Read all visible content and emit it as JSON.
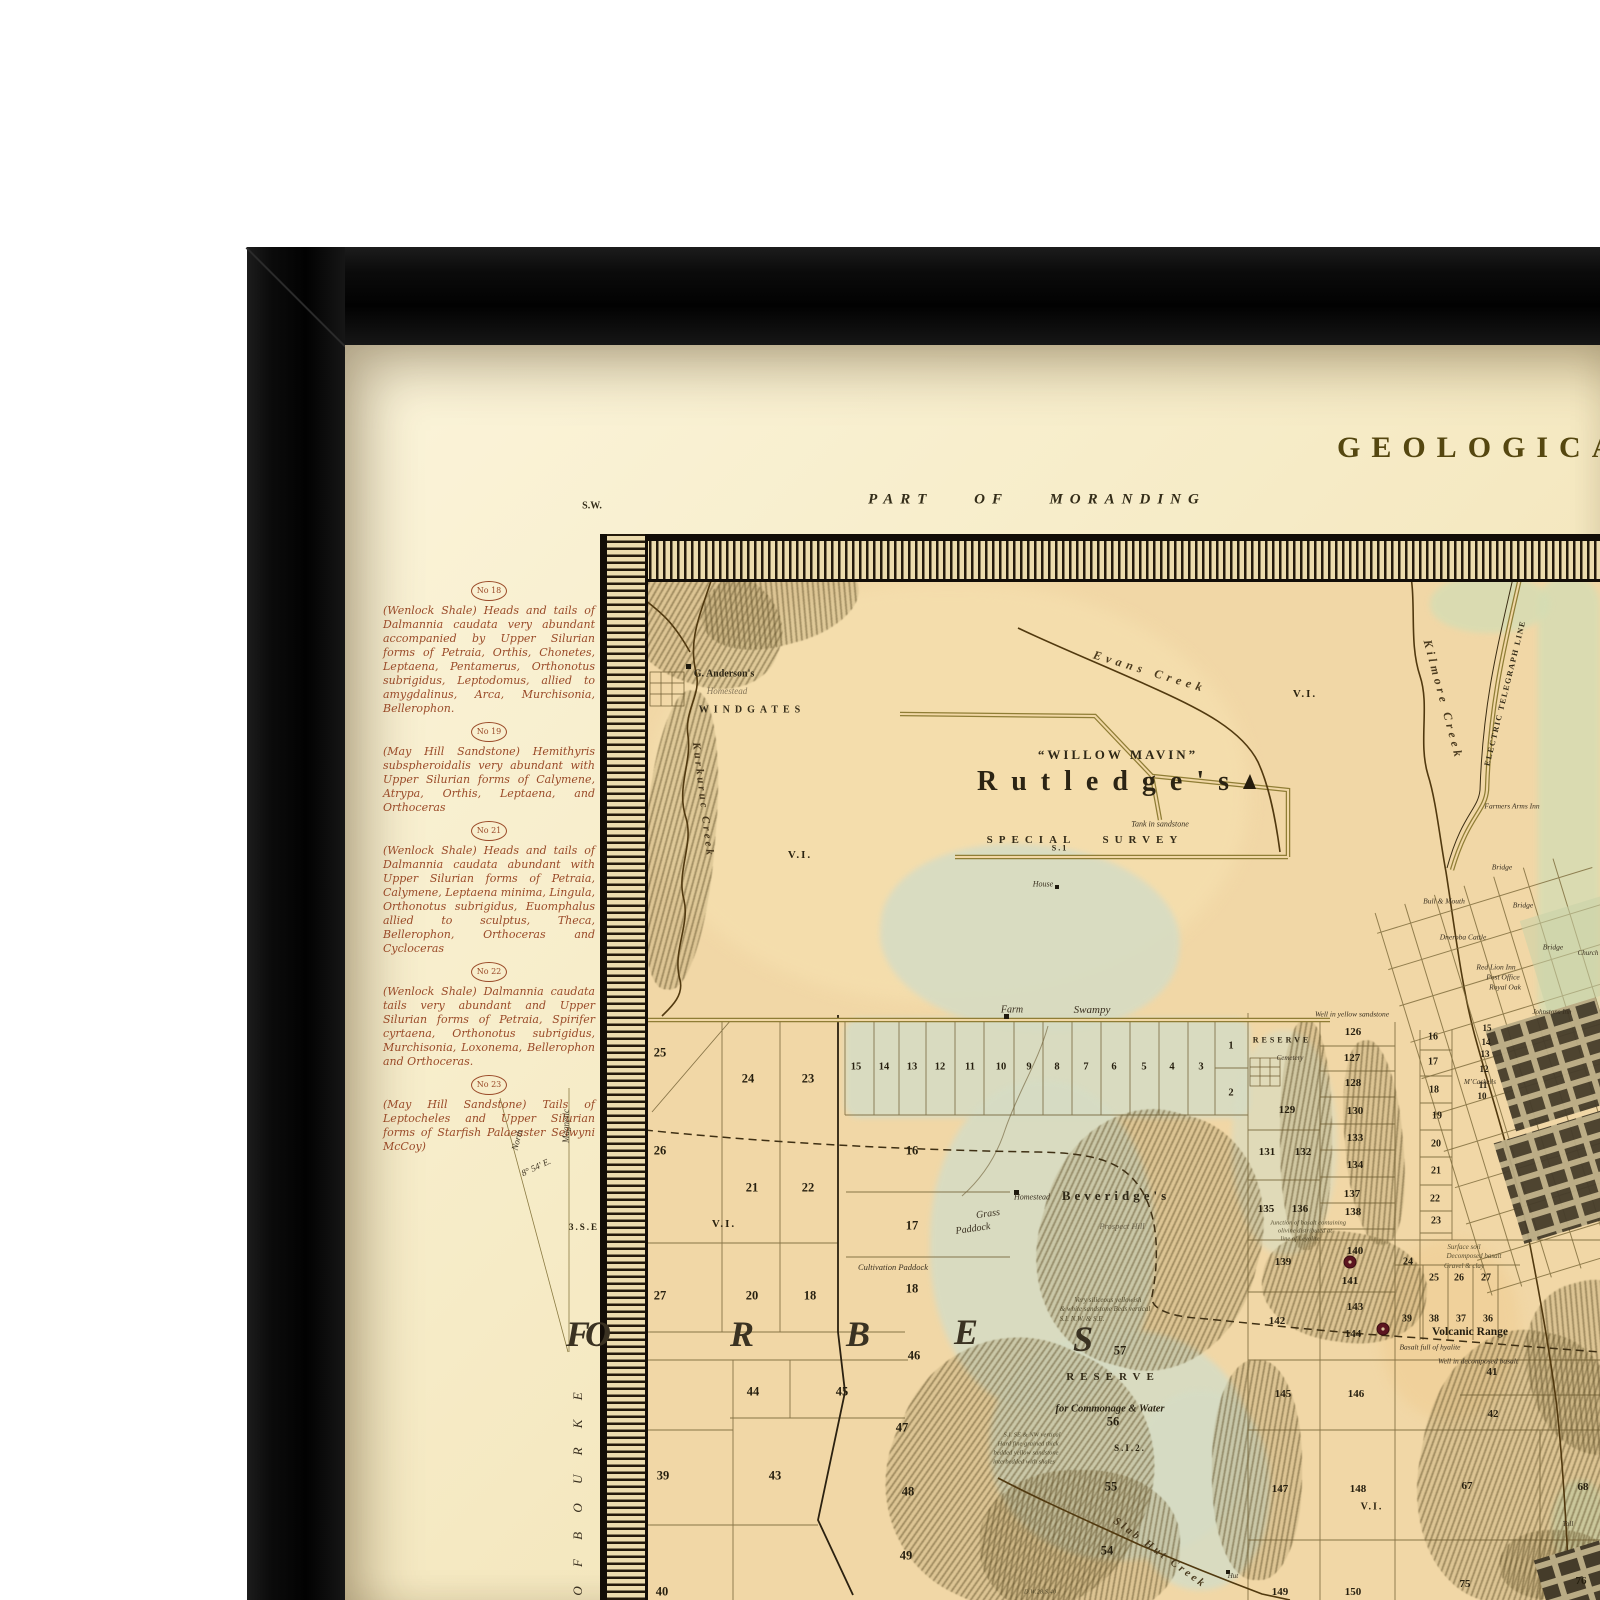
{
  "colors": {
    "frame": "#0b0b0b",
    "paper": "#f6ecca",
    "map_ground": "#f1d7a6",
    "swamp": "#d6dcc4",
    "hills": "#7d6f45",
    "ink": "#3a3020",
    "margin_ink": "#9a4a28",
    "crater": "#5c1520"
  },
  "paper": {
    "title": "GEOLOGICAL",
    "district_label": "PART OF MORANDING",
    "corner_label": "S.W."
  },
  "margin": {
    "notes": [
      {
        "no": "No 18",
        "text": "(Wenlock Shale) Heads and tails of Dalmannia caudata very abundant accompanied by Upper Silurian forms of Petraia, Orthis, Chonetes, Leptaena, Pentamerus, Orthonotus subrigidus, Leptodomus, allied to amygdalinus, Arca, Murchisonia, Bellerophon."
      },
      {
        "no": "No 19",
        "text": "(May Hill Sandstone) Hemithyris subspheroidalis very abundant with Upper Silurian forms of Calymene, Atrypa, Orthis, Leptaena, and Orthoceras"
      },
      {
        "no": "No 21",
        "text": "(Wenlock Shale) Heads and tails of Dalmannia caudata abundant with Upper Silurian forms of Petraia, Calymene, Leptaena minima, Lingula, Orthonotus subrigidus, Euomphalus allied to sculptus, Theca, Bellerophon, Orthoceras and Cycloceras"
      },
      {
        "no": "No 22",
        "text": "(Wenlock Shale) Dalmannia caudata tails very abundant and Upper Silurian forms of Petraia, Spirifer cyrtaena, Orthonotus subrigidus, Murchisonia, Loxonema, Bellerophon and Orthoceras."
      },
      {
        "no": "No 23",
        "text": "(May Hill Sandstone) Tails of Leptocheles and Upper Silurian forms of Starfish Palaeaster Selwyni McCoy)"
      }
    ]
  },
  "declination": {
    "north_label": "North",
    "magnetic_label": "Magnetic",
    "angle": "8° 54' E.",
    "se_mark": "3.S.E"
  },
  "map": {
    "labels": [
      {
        "t": "G. Anderson's",
        "x": 724,
        "y": 674,
        "s": 10,
        "c": "name"
      },
      {
        "t": "Homestead",
        "x": 727,
        "y": 691,
        "s": 9,
        "c": "it faint"
      },
      {
        "t": "WINDGATES",
        "x": 752,
        "y": 710,
        "s": 10,
        "ls": 5,
        "c": "sc"
      },
      {
        "t": "Kurkuruc Creek",
        "x": 703,
        "y": 800,
        "r": 83,
        "s": 11,
        "ls": 3,
        "c": "creek"
      },
      {
        "t": "Evans Creek",
        "x": 1150,
        "y": 672,
        "r": 17,
        "s": 12,
        "ls": 5,
        "c": "creek"
      },
      {
        "t": "V.I.",
        "x": 1305,
        "y": 694,
        "s": 11,
        "c": "num2"
      },
      {
        "t": "Kilmore Creek",
        "x": 1443,
        "y": 700,
        "r": 75,
        "s": 12,
        "ls": 4,
        "c": "creek"
      },
      {
        "t": "ELECTRIC TELEGRAPH LINE",
        "x": 1505,
        "y": 693,
        "r": -76,
        "s": 8,
        "ls": 1.5,
        "c": "sc"
      },
      {
        "t": "Farmers Arms Inn",
        "x": 1512,
        "y": 806,
        "s": 7.5,
        "c": "it"
      },
      {
        "t": "“WILLOW MAVIN”",
        "x": 1118,
        "y": 755,
        "s": 13,
        "ls": 3,
        "c": "bsc"
      },
      {
        "t": "Rutledge's",
        "x": 1110,
        "y": 782,
        "s": 28,
        "ls": 14,
        "c": "name2"
      },
      {
        "t": "Tank in sandstone",
        "x": 1160,
        "y": 824,
        "s": 8,
        "c": "it"
      },
      {
        "t": "S.1",
        "x": 1060,
        "y": 848,
        "s": 8,
        "c": "num2"
      },
      {
        "t": "SPECIAL SURVEY",
        "x": 1085,
        "y": 840,
        "s": 11,
        "ls": 6,
        "ws": 18,
        "c": "sc"
      },
      {
        "t": "House",
        "x": 1043,
        "y": 884,
        "s": 8,
        "c": "it"
      },
      {
        "t": "V.I.",
        "x": 800,
        "y": 855,
        "s": 11,
        "c": "num2"
      },
      {
        "t": "Farm",
        "x": 1012,
        "y": 1010,
        "s": 10,
        "c": "it"
      },
      {
        "t": "Swampy",
        "x": 1092,
        "y": 1010,
        "s": 11,
        "c": "it"
      },
      {
        "t": "Well in yellow sandstone",
        "x": 1352,
        "y": 1014,
        "s": 7.5,
        "c": "it"
      },
      {
        "t": "RESERVE",
        "x": 1282,
        "y": 1040,
        "s": 8,
        "ls": 3,
        "c": "sc"
      },
      {
        "t": "Cemetery",
        "x": 1290,
        "y": 1058,
        "s": 7,
        "c": "it"
      },
      {
        "t": "M’Caskells",
        "x": 1480,
        "y": 1082,
        "s": 7,
        "c": "it"
      },
      {
        "t": "Bridge",
        "x": 1502,
        "y": 867,
        "s": 7.5,
        "c": "it"
      },
      {
        "t": "Bull & Mouth",
        "x": 1444,
        "y": 901,
        "s": 7.5,
        "c": "it"
      },
      {
        "t": "Bridge",
        "x": 1523,
        "y": 905,
        "s": 7.5,
        "c": "it"
      },
      {
        "t": "Dneroba Cattle",
        "x": 1463,
        "y": 937,
        "s": 7.5,
        "c": "it"
      },
      {
        "t": "Bridge",
        "x": 1553,
        "y": 947,
        "s": 7.5,
        "c": "it"
      },
      {
        "t": "Church",
        "x": 1588,
        "y": 953,
        "s": 7,
        "c": "it"
      },
      {
        "t": "Red Lion Inn",
        "x": 1496,
        "y": 967,
        "s": 7.5,
        "c": "it"
      },
      {
        "t": "Post Office",
        "x": 1503,
        "y": 977,
        "s": 7.5,
        "c": "it"
      },
      {
        "t": "Royal Oak",
        "x": 1505,
        "y": 987,
        "s": 7.5,
        "c": "it"
      },
      {
        "t": "Johnstons Inn",
        "x": 1552,
        "y": 1012,
        "s": 7,
        "c": "it"
      },
      {
        "t": "Grass",
        "x": 988,
        "y": 1214,
        "r": -8,
        "s": 10,
        "c": "it"
      },
      {
        "t": "Paddock",
        "x": 973,
        "y": 1229,
        "r": -8,
        "s": 10,
        "c": "it"
      },
      {
        "t": "Homestead",
        "x": 1032,
        "y": 1197,
        "s": 8,
        "c": "it"
      },
      {
        "t": "Beveridge's",
        "x": 1116,
        "y": 1196,
        "s": 13,
        "ls": 4,
        "c": "name"
      },
      {
        "t": "Prospect Hill",
        "x": 1122,
        "y": 1226,
        "s": 8.5,
        "c": "it faint"
      },
      {
        "t": "Cultivation Paddock",
        "x": 893,
        "y": 1267,
        "s": 8.5,
        "c": "it"
      },
      {
        "t": "V.I.",
        "x": 724,
        "y": 1224,
        "s": 11,
        "c": "num2"
      },
      {
        "t": "F",
        "x": 578,
        "y": 1334,
        "s": 36,
        "c": "big"
      },
      {
        "t": "O",
        "x": 598,
        "y": 1334,
        "s": 36,
        "c": "big"
      },
      {
        "t": "R",
        "x": 742,
        "y": 1334,
        "s": 36,
        "c": "big"
      },
      {
        "t": "B",
        "x": 858,
        "y": 1334,
        "s": 36,
        "c": "big"
      },
      {
        "t": "E",
        "x": 966,
        "y": 1332,
        "s": 36,
        "c": "big"
      },
      {
        "t": "S",
        "x": 1083,
        "y": 1339,
        "s": 36,
        "c": "big"
      },
      {
        "t": "Very siliceous yellowish",
        "x": 1108,
        "y": 1300,
        "s": 7,
        "c": "note"
      },
      {
        "t": "& white sandstone Beds vertical",
        "x": 1105,
        "y": 1309,
        "s": 7,
        "c": "note"
      },
      {
        "t": "S.I. N.W. & S.E.",
        "x": 1082,
        "y": 1319,
        "s": 7,
        "c": "note"
      },
      {
        "t": "RESERVE",
        "x": 1113,
        "y": 1377,
        "s": 11,
        "ls": 6,
        "c": "sc"
      },
      {
        "t": "for Commonage & Water",
        "x": 1110,
        "y": 1409,
        "s": 10.5,
        "c": "bit"
      },
      {
        "t": "S.I.2.",
        "x": 1130,
        "y": 1448,
        "s": 9,
        "c": "num2"
      },
      {
        "t": "S.I. SE & NW vertical",
        "x": 1032,
        "y": 1435,
        "s": 6.5,
        "c": "note"
      },
      {
        "t": "Hard fine grained thick",
        "x": 1028,
        "y": 1444,
        "s": 6.5,
        "c": "note"
      },
      {
        "t": "bedded yellow sandstone",
        "x": 1026,
        "y": 1453,
        "s": 6.5,
        "c": "note"
      },
      {
        "t": "interbedded with shales",
        "x": 1024,
        "y": 1462,
        "s": 6.5,
        "c": "note"
      },
      {
        "t": "Slab Hut Creek",
        "x": 1160,
        "y": 1553,
        "r": 36,
        "s": 11,
        "ls": 3,
        "c": "creek"
      },
      {
        "t": "Hut",
        "x": 1233,
        "y": 1576,
        "s": 7,
        "c": "it"
      },
      {
        "t": "Surface soil",
        "x": 1464,
        "y": 1247,
        "s": 7,
        "c": "note"
      },
      {
        "t": "Decomposed basalt",
        "x": 1474,
        "y": 1256,
        "s": 7,
        "c": "note"
      },
      {
        "t": "Gravel & clay",
        "x": 1464,
        "y": 1266,
        "s": 7,
        "c": "note"
      },
      {
        "t": "Volcanic Range",
        "x": 1470,
        "y": 1332,
        "s": 11.5,
        "c": "bname"
      },
      {
        "t": "Basalt full of hyalite",
        "x": 1430,
        "y": 1347,
        "s": 7.5,
        "c": "it"
      },
      {
        "t": "Well in decomposed basalt",
        "x": 1478,
        "y": 1361,
        "s": 7.5,
        "c": "it"
      },
      {
        "t": "Junction of basalt containing",
        "x": 1308,
        "y": 1223,
        "s": 6.5,
        "c": "note"
      },
      {
        "t": "olivine distributed at",
        "x": 1305,
        "y": 1231,
        "s": 6.5,
        "c": "note"
      },
      {
        "t": "line of Leyolite",
        "x": 1300,
        "y": 1239,
        "s": 6.5,
        "c": "note"
      },
      {
        "t": "V.I.",
        "x": 1372,
        "y": 1507,
        "s": 10,
        "c": "num2"
      },
      {
        "t": "Toll",
        "x": 1568,
        "y": 1524,
        "s": 7,
        "c": "it"
      },
      {
        "t": "D.W.28.S.40",
        "x": 1040,
        "y": 1592,
        "s": 6.5,
        "c": "note"
      },
      {
        "t": "3.S.E",
        "x": 584,
        "y": 1227,
        "s": 9,
        "c": "num2"
      },
      {
        "t": "North",
        "x": 517,
        "y": 1140,
        "r": -75,
        "s": 9,
        "c": "it"
      },
      {
        "t": "Magnetic",
        "x": 566,
        "y": 1126,
        "r": -90,
        "s": 9,
        "c": "it"
      },
      {
        "t": "8° 54' E.",
        "x": 536,
        "y": 1167,
        "r": -25,
        "s": 9,
        "c": "it"
      },
      {
        "t": "O F   B O U R K E",
        "x": 578,
        "y": 1490,
        "r": -90,
        "s": 13,
        "ls": 8,
        "c": "it"
      }
    ],
    "parcels": [
      {
        "n": "25",
        "x": 660,
        "y": 1053
      },
      {
        "n": "24",
        "x": 748,
        "y": 1079
      },
      {
        "n": "23",
        "x": 808,
        "y": 1079
      },
      {
        "n": "15",
        "x": 856,
        "y": 1067,
        "s": 10.5
      },
      {
        "n": "14",
        "x": 884,
        "y": 1067,
        "s": 10.5
      },
      {
        "n": "13",
        "x": 912,
        "y": 1067,
        "s": 10.5
      },
      {
        "n": "12",
        "x": 940,
        "y": 1067,
        "s": 10.5
      },
      {
        "n": "11",
        "x": 970,
        "y": 1067,
        "s": 10.5
      },
      {
        "n": "10",
        "x": 1001,
        "y": 1067,
        "s": 10.5
      },
      {
        "n": "9",
        "x": 1029,
        "y": 1067,
        "s": 10.5
      },
      {
        "n": "8",
        "x": 1057,
        "y": 1067,
        "s": 10.5
      },
      {
        "n": "7",
        "x": 1086,
        "y": 1067,
        "s": 10.5
      },
      {
        "n": "6",
        "x": 1114,
        "y": 1067,
        "s": 10.5
      },
      {
        "n": "5",
        "x": 1144,
        "y": 1067,
        "s": 10.5
      },
      {
        "n": "4",
        "x": 1172,
        "y": 1067,
        "s": 10.5
      },
      {
        "n": "3",
        "x": 1201,
        "y": 1067,
        "s": 10.5
      },
      {
        "n": "1",
        "x": 1231,
        "y": 1046,
        "s": 10.5
      },
      {
        "n": "2",
        "x": 1231,
        "y": 1093,
        "s": 10.5
      },
      {
        "n": "26",
        "x": 660,
        "y": 1151
      },
      {
        "n": "16",
        "x": 912,
        "y": 1151
      },
      {
        "n": "21",
        "x": 752,
        "y": 1188
      },
      {
        "n": "22",
        "x": 808,
        "y": 1188
      },
      {
        "n": "17",
        "x": 912,
        "y": 1226
      },
      {
        "n": "27",
        "x": 660,
        "y": 1296
      },
      {
        "n": "20",
        "x": 752,
        "y": 1296
      },
      {
        "n": "18",
        "x": 810,
        "y": 1296
      },
      {
        "n": "18",
        "x": 912,
        "y": 1289
      },
      {
        "n": "46",
        "x": 914,
        "y": 1356
      },
      {
        "n": "57",
        "x": 1120,
        "y": 1351
      },
      {
        "n": "56",
        "x": 1113,
        "y": 1422
      },
      {
        "n": "55",
        "x": 1111,
        "y": 1487
      },
      {
        "n": "54",
        "x": 1107,
        "y": 1551
      },
      {
        "n": "44",
        "x": 753,
        "y": 1392
      },
      {
        "n": "45",
        "x": 842,
        "y": 1392
      },
      {
        "n": "39",
        "x": 663,
        "y": 1476
      },
      {
        "n": "43",
        "x": 775,
        "y": 1476
      },
      {
        "n": "47",
        "x": 902,
        "y": 1428
      },
      {
        "n": "48",
        "x": 908,
        "y": 1492
      },
      {
        "n": "49",
        "x": 906,
        "y": 1556
      },
      {
        "n": "40",
        "x": 662,
        "y": 1592
      },
      {
        "n": "126",
        "x": 1353,
        "y": 1032,
        "s": 11
      },
      {
        "n": "127",
        "x": 1352,
        "y": 1058,
        "s": 11
      },
      {
        "n": "128",
        "x": 1353,
        "y": 1083,
        "s": 11
      },
      {
        "n": "129",
        "x": 1287,
        "y": 1110,
        "s": 11
      },
      {
        "n": "130",
        "x": 1355,
        "y": 1111,
        "s": 11
      },
      {
        "n": "133",
        "x": 1355,
        "y": 1138,
        "s": 11
      },
      {
        "n": "131",
        "x": 1267,
        "y": 1152,
        "s": 11
      },
      {
        "n": "132",
        "x": 1303,
        "y": 1152,
        "s": 11
      },
      {
        "n": "134",
        "x": 1355,
        "y": 1165,
        "s": 11
      },
      {
        "n": "137",
        "x": 1352,
        "y": 1194,
        "s": 11
      },
      {
        "n": "135",
        "x": 1266,
        "y": 1209,
        "s": 11
      },
      {
        "n": "136",
        "x": 1300,
        "y": 1209,
        "s": 11
      },
      {
        "n": "138",
        "x": 1353,
        "y": 1212,
        "s": 11
      },
      {
        "n": "16",
        "x": 1433,
        "y": 1037,
        "s": 10
      },
      {
        "n": "17",
        "x": 1433,
        "y": 1062,
        "s": 10
      },
      {
        "n": "18",
        "x": 1434,
        "y": 1090,
        "s": 10
      },
      {
        "n": "19",
        "x": 1437,
        "y": 1116,
        "s": 10
      },
      {
        "n": "20",
        "x": 1436,
        "y": 1144,
        "s": 10
      },
      {
        "n": "21",
        "x": 1436,
        "y": 1171,
        "s": 10
      },
      {
        "n": "22",
        "x": 1435,
        "y": 1199,
        "s": 10
      },
      {
        "n": "23",
        "x": 1436,
        "y": 1221,
        "s": 10
      },
      {
        "n": "15",
        "x": 1487,
        "y": 1028,
        "s": 9
      },
      {
        "n": "14",
        "x": 1486,
        "y": 1042,
        "s": 9
      },
      {
        "n": "13",
        "x": 1485,
        "y": 1054,
        "s": 9
      },
      {
        "n": "12",
        "x": 1484,
        "y": 1069,
        "s": 9
      },
      {
        "n": "11",
        "x": 1483,
        "y": 1085,
        "s": 9
      },
      {
        "n": "10",
        "x": 1482,
        "y": 1096,
        "s": 9
      },
      {
        "n": "139",
        "x": 1283,
        "y": 1262,
        "s": 11
      },
      {
        "n": "140",
        "x": 1355,
        "y": 1251,
        "s": 11
      },
      {
        "n": "141",
        "x": 1350,
        "y": 1281,
        "s": 11
      },
      {
        "n": "24",
        "x": 1408,
        "y": 1262,
        "s": 10
      },
      {
        "n": "25",
        "x": 1434,
        "y": 1278,
        "s": 10
      },
      {
        "n": "26",
        "x": 1459,
        "y": 1278,
        "s": 10
      },
      {
        "n": "27",
        "x": 1486,
        "y": 1278,
        "s": 10
      },
      {
        "n": "142",
        "x": 1277,
        "y": 1321,
        "s": 11
      },
      {
        "n": "143",
        "x": 1355,
        "y": 1307,
        "s": 11
      },
      {
        "n": "39",
        "x": 1407,
        "y": 1319,
        "s": 10
      },
      {
        "n": "38",
        "x": 1434,
        "y": 1319,
        "s": 10
      },
      {
        "n": "37",
        "x": 1461,
        "y": 1319,
        "s": 10
      },
      {
        "n": "36",
        "x": 1488,
        "y": 1319,
        "s": 10
      },
      {
        "n": "144",
        "x": 1353,
        "y": 1334,
        "s": 11
      },
      {
        "n": "41",
        "x": 1492,
        "y": 1372,
        "s": 11
      },
      {
        "n": "42",
        "x": 1493,
        "y": 1414,
        "s": 11
      },
      {
        "n": "145",
        "x": 1283,
        "y": 1394,
        "s": 11
      },
      {
        "n": "146",
        "x": 1356,
        "y": 1394,
        "s": 11
      },
      {
        "n": "147",
        "x": 1280,
        "y": 1489,
        "s": 11
      },
      {
        "n": "148",
        "x": 1358,
        "y": 1489,
        "s": 11
      },
      {
        "n": "67",
        "x": 1467,
        "y": 1486,
        "s": 11
      },
      {
        "n": "68",
        "x": 1583,
        "y": 1487,
        "s": 11
      },
      {
        "n": "149",
        "x": 1280,
        "y": 1592,
        "s": 11
      },
      {
        "n": "150",
        "x": 1353,
        "y": 1592,
        "s": 11
      },
      {
        "n": "75",
        "x": 1465,
        "y": 1584,
        "s": 11
      },
      {
        "n": "76",
        "x": 1581,
        "y": 1581,
        "s": 11
      }
    ]
  }
}
